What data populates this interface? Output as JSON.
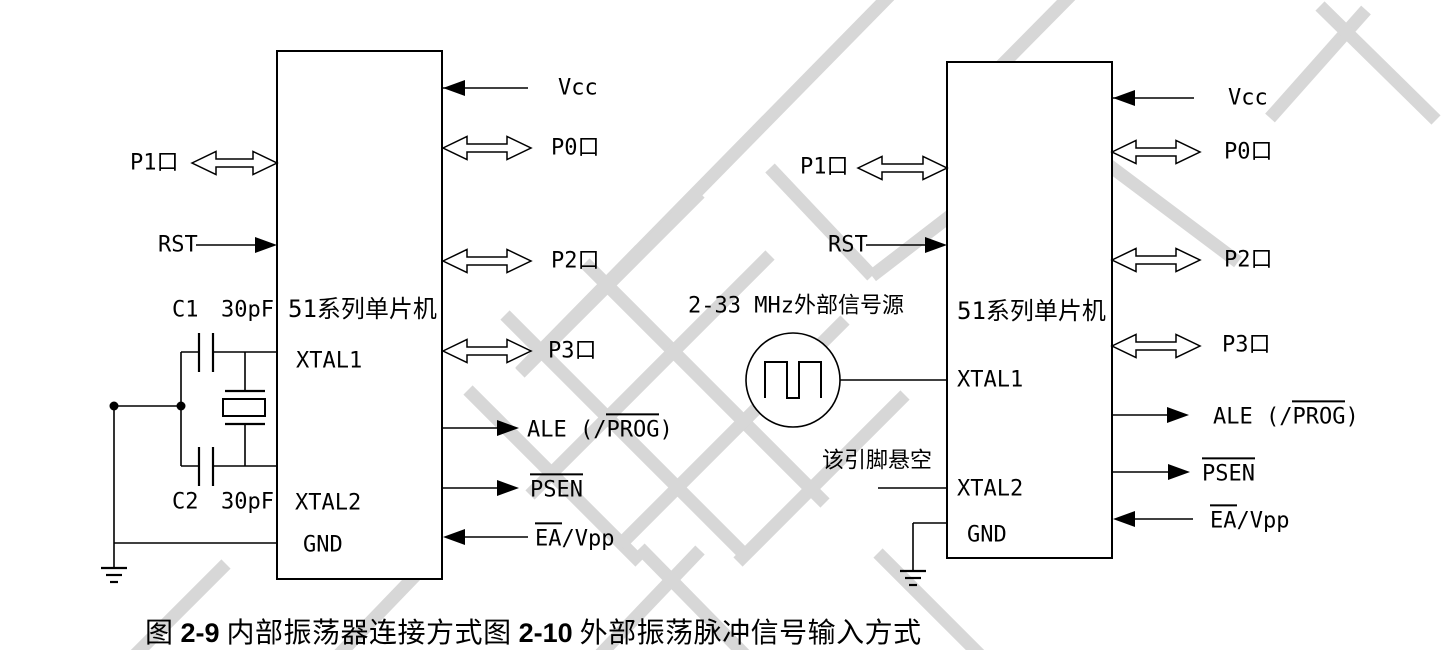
{
  "figure": {
    "caption": {
      "fig1_prefix": "图",
      "fig1_num": "2-9",
      "fig1_title": "内部振荡器连接方式",
      "fig2_prefix": "图",
      "fig2_num": "2-10",
      "fig2_title": "外部振荡脉冲信号输入方式"
    },
    "colors": {
      "line": "#000000",
      "watermark": "#d7d7d7",
      "background": "#ffffff"
    }
  },
  "left_diagram": {
    "chip_label": "51系列单片机",
    "pins": {
      "xtal1": "XTAL1",
      "xtal2": "XTAL2",
      "gnd": "GND"
    },
    "left_labels": {
      "p1": "P1口",
      "rst": "RST"
    },
    "right_labels": {
      "vcc": "Vcc",
      "p0": "P0口",
      "p2": "P2口",
      "p3": "P3口",
      "ale_prefix": "ALE (/",
      "ale_overlined": "PROG",
      "ale_suffix": ")",
      "psen_overlined": "PSEN",
      "ea_overlined": "EA",
      "ea_suffix": "/Vpp"
    },
    "components": {
      "c1": "C1",
      "c1_value": "30pF",
      "c2": "C2",
      "c2_value": "30pF",
      "crystal": "crystal-oscillator"
    }
  },
  "right_diagram": {
    "chip_label": "51系列单片机",
    "pins": {
      "xtal1": "XTAL1",
      "xtal2": "XTAL2",
      "gnd": "GND"
    },
    "left_labels": {
      "p1": "P1口",
      "rst": "RST",
      "signal_source": "2-33 MHz外部信号源",
      "floating_pin": "该引脚悬空"
    },
    "right_labels": {
      "vcc": "Vcc",
      "p0": "P0口",
      "p2": "P2口",
      "p3": "P3口",
      "ale_prefix": "ALE (/",
      "ale_overlined": "PROG",
      "ale_suffix": ")",
      "psen_overlined": "PSEN",
      "ea_overlined": "EA",
      "ea_suffix": "/Vpp"
    }
  }
}
